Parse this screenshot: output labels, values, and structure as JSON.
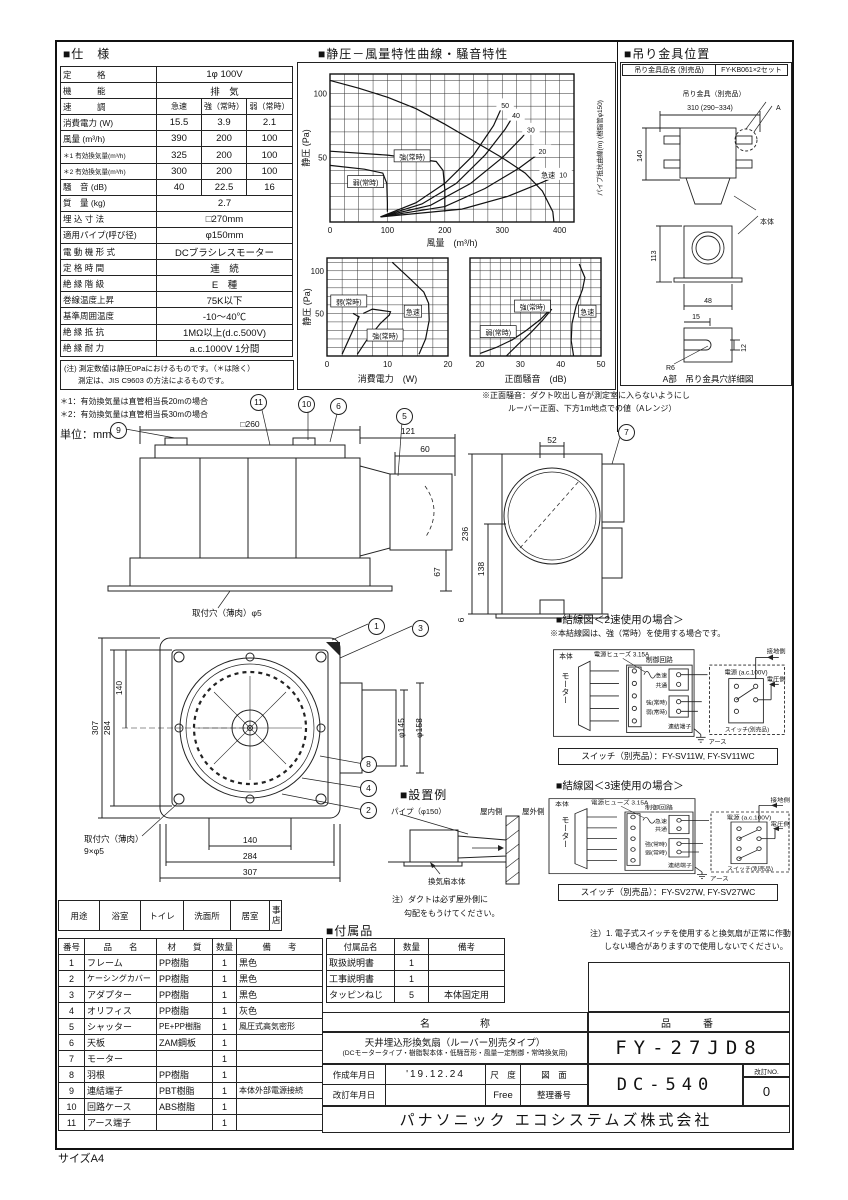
{
  "page": {
    "size_label": "サイズA4",
    "unit_label": "単位：mm"
  },
  "spec": {
    "title": "■仕　様",
    "rows": [
      {
        "label": "定　　　格",
        "value": "1φ 100V"
      },
      {
        "label": "機　　　能",
        "value": "排　気"
      },
      {
        "label": "速　　　調",
        "c1": "急速",
        "c2": "強（常時）",
        "c3": "弱（常時）"
      },
      {
        "label": "消費電力 (W)",
        "c1": "15.5",
        "c2": "3.9",
        "c3": "2.1"
      },
      {
        "label": "風量 (m³/h)",
        "c1": "390",
        "c2": "200",
        "c3": "100"
      },
      {
        "label": "＊1 有効換気量(m³/h)",
        "c1": "325",
        "c2": "200",
        "c3": "100"
      },
      {
        "label": "＊2 有効換気量(m³/h)",
        "c1": "300",
        "c2": "200",
        "c3": "100"
      },
      {
        "label": "騒　音 (dB)",
        "c1": "40",
        "c2": "22.5",
        "c3": "16"
      },
      {
        "label": "質　量 (kg)",
        "value": "2.7"
      },
      {
        "label": "埋 込 寸 法",
        "value": "□270mm"
      },
      {
        "label": "適用パイプ(呼び径)",
        "value": "φ150mm"
      },
      {
        "label": "電 動 機 形 式",
        "value": "DCブラシレスモーター"
      },
      {
        "label": "定 格 時 間",
        "value": "連　続"
      },
      {
        "label": "絶 縁 階 級",
        "value": "E　種"
      },
      {
        "label": "巻線温度上昇",
        "value": "75K以下"
      },
      {
        "label": "基準周囲温度",
        "value": "-10～40℃"
      },
      {
        "label": "絶 縁 抵 抗",
        "value": "1MΩ以上(d.c.500V)"
      },
      {
        "label": "絶 縁 耐 力",
        "value": "a.c.1000V 1分間"
      }
    ],
    "note1": "(注) 測定数値は静圧0Paにおけるものです。（＊は除く）",
    "note2": "測定は、JIS C9603 の方法によるものです。",
    "note3": "＊1：有効換気量は直管相当長20mの場合",
    "note4": "＊2：有効換気量は直管相当長30mの場合"
  },
  "charts": {
    "section_title": "■静圧－風量特性曲線・騒音特性",
    "note1": "※正面騒音：ダクト吹出し音が測定室に入らないようにし",
    "note2": "ルーバー正面、下方1m地点での値（Aレンジ）"
  },
  "chart_data": [
    {
      "id": "pq",
      "type": "line",
      "title": "静圧-風量特性曲線",
      "xlabel": "風量　(m³/h)",
      "ylabel": "静圧 (Pa)",
      "ylabel_right": "パイプ抵抗曲線(m) (樹脂管φ150)",
      "xlim": [
        0,
        425
      ],
      "ylim": [
        0,
        115
      ],
      "xgrid": 25,
      "ygrid": 10,
      "xticks": [
        0,
        100,
        200,
        300,
        400
      ],
      "yticks": [
        50,
        100
      ],
      "series": [
        {
          "name": "急速",
          "points": [
            [
              0,
              110
            ],
            [
              50,
              104
            ],
            [
              100,
              97
            ],
            [
              150,
              88
            ],
            [
              200,
              76
            ],
            [
              250,
              63
            ],
            [
              300,
              50
            ],
            [
              340,
              38
            ],
            [
              370,
              24
            ],
            [
              388,
              8
            ],
            [
              390,
              0
            ]
          ]
        },
        {
          "name": "強(常時)",
          "points": [
            [
              0,
              55
            ],
            [
              100,
              52
            ],
            [
              185,
              47
            ],
            [
              197,
              40
            ],
            [
              200,
              25
            ],
            [
              200,
              8
            ]
          ]
        },
        {
          "name": "弱(常時)",
          "points": [
            [
              0,
              44
            ],
            [
              60,
              41
            ],
            [
              92,
              38
            ],
            [
              99,
              30
            ],
            [
              100,
              15
            ],
            [
              100,
              8
            ]
          ]
        },
        {
          "name": "パイプ抵抗50m",
          "points": [
            [
              88,
              4
            ],
            [
              150,
              15
            ],
            [
              200,
              30
            ],
            [
              250,
              52
            ],
            [
              285,
              75
            ],
            [
              298,
              88
            ]
          ]
        },
        {
          "name": "パイプ抵抗40m",
          "points": [
            [
              88,
              4
            ],
            [
              160,
              14
            ],
            [
              220,
              30
            ],
            [
              270,
              52
            ],
            [
              305,
              72
            ],
            [
              316,
              80
            ]
          ]
        },
        {
          "name": "パイプ抵抗30m",
          "points": [
            [
              88,
              4
            ],
            [
              175,
              13
            ],
            [
              245,
              30
            ],
            [
              300,
              50
            ],
            [
              335,
              66
            ],
            [
              342,
              70
            ]
          ]
        },
        {
          "name": "パイプ抵抗20m",
          "points": [
            [
              88,
              4
            ],
            [
              200,
              12
            ],
            [
              270,
              26
            ],
            [
              330,
              42
            ],
            [
              360,
              52
            ]
          ]
        },
        {
          "name": "パイプ抵抗10m",
          "points": [
            [
              88,
              4
            ],
            [
              230,
              10
            ],
            [
              310,
              20
            ],
            [
              365,
              30
            ],
            [
              396,
              36
            ]
          ]
        }
      ],
      "labels": [
        {
          "text": "50",
          "x": 305,
          "y": 91
        },
        {
          "text": "40",
          "x": 324,
          "y": 83
        },
        {
          "text": "30",
          "x": 350,
          "y": 72
        },
        {
          "text": "20",
          "x": 370,
          "y": 55
        },
        {
          "text": "10",
          "x": 406,
          "y": 37
        },
        {
          "text": "急速",
          "x": 380,
          "y": 37
        },
        {
          "text": "強(常時)",
          "x": 143,
          "y": 51,
          "boxed": true
        },
        {
          "text": "弱(常時)",
          "x": 62,
          "y": 31,
          "boxed": true
        }
      ]
    },
    {
      "id": "power",
      "type": "line",
      "xlabel": "消費電力　(W)",
      "ylabel": "静圧 (Pa)",
      "xlim": [
        0,
        20
      ],
      "ylim": [
        0,
        115
      ],
      "xgrid": 2.5,
      "ygrid": 10,
      "xticks": [
        0,
        10,
        20
      ],
      "yticks": [
        50,
        100
      ],
      "series": [
        {
          "name": "弱(常時)",
          "points": [
            [
              2.5,
              2
            ],
            [
              3.5,
              18
            ],
            [
              4.8,
              38
            ],
            [
              5.3,
              46
            ],
            [
              4.3,
              50
            ]
          ]
        },
        {
          "name": "強(常時)",
          "points": [
            [
              5,
              2
            ],
            [
              6.5,
              18
            ],
            [
              8.8,
              38
            ],
            [
              10.3,
              48
            ],
            [
              10.5,
              52
            ],
            [
              7.5,
              55
            ],
            [
              6,
              50
            ]
          ]
        },
        {
          "name": "急速",
          "points": [
            [
              15.2,
              2
            ],
            [
              16.3,
              20
            ],
            [
              16.9,
              42
            ],
            [
              16.8,
              62
            ],
            [
              16,
              75
            ],
            [
              13.5,
              92
            ],
            [
              10.8,
              110
            ]
          ]
        }
      ],
      "labels": [
        {
          "text": "弱(常時)",
          "x": 3.6,
          "y": 64,
          "boxed": true
        },
        {
          "text": "強(常時)",
          "x": 9.6,
          "y": 24,
          "boxed": true
        },
        {
          "text": "急速",
          "x": 14.2,
          "y": 52,
          "boxed": true
        }
      ]
    },
    {
      "id": "noise",
      "type": "line",
      "xlabel": "正面騒音　(dB)",
      "xlim": [
        17.5,
        50
      ],
      "ylim": [
        0,
        115
      ],
      "xgrid": 2.5,
      "ygrid": 10,
      "xticks": [
        20,
        30,
        40,
        50
      ],
      "yticks": [],
      "series": [
        {
          "name": "弱(常時)",
          "points": [
            [
              20,
              3
            ],
            [
              24,
              10
            ],
            [
              28,
              19
            ],
            [
              31.5,
              30
            ],
            [
              35,
              43
            ],
            [
              37.5,
              55
            ]
          ]
        },
        {
          "name": "強(常時)",
          "points": [
            [
              26.5,
              0
            ],
            [
              29.5,
              14
            ],
            [
              32.5,
              27
            ],
            [
              35.5,
              42
            ],
            [
              37.8,
              55
            ]
          ]
        },
        {
          "name": "急速",
          "points": [
            [
              43.2,
              0
            ],
            [
              42.6,
              18
            ],
            [
              42.8,
              38
            ],
            [
              43.8,
              58
            ],
            [
              45.4,
              78
            ],
            [
              46,
              92
            ],
            [
              44.6,
              108
            ]
          ]
        }
      ],
      "labels": [
        {
          "text": "弱(常時)",
          "x": 24.5,
          "y": 28,
          "boxed": true
        },
        {
          "text": "強(常時)",
          "x": 33,
          "y": 58,
          "boxed": true
        },
        {
          "text": "急速",
          "x": 46.6,
          "y": 52,
          "boxed": true
        }
      ]
    }
  ],
  "bracket": {
    "title": "■吊り金具位置",
    "part_label": "吊り金具品名 (別売品)",
    "part_value": "FY-KB061×2セット",
    "hanger_label": "吊り金具（別売品）",
    "dim140": "140",
    "dim310": "310 (290~334)",
    "mark_a": "A",
    "body_label": "本体",
    "dim113": "113",
    "dim48": "48",
    "dim15": "15",
    "dim12": "12",
    "dimr6": "R6",
    "caption": "A部　吊り金具穴詳細図"
  },
  "drawings": {
    "dim260": "□260",
    "dim121": "121",
    "dim60": "60",
    "dim236": "236",
    "dim67": "67",
    "dim6": "6",
    "hole5": "取付穴（薄肉）φ5",
    "dim52": "52",
    "dim138": "138",
    "dim307a": "307",
    "dim284a": "284",
    "dim140a": "140",
    "dim140b": "140",
    "dim284b": "284",
    "dim307b": "307",
    "d145": "φ145",
    "d158": "φ158",
    "hole9a": "取付穴（薄肉）",
    "hole9b": "9×φ5"
  },
  "install": {
    "title": "■設置例",
    "pipe": "パイプ（φ150）",
    "indoor": "屋内側",
    "outdoor": "屋外側",
    "body": "換気扇本体",
    "note1": "注）ダクトは必ず屋外側に",
    "note2": "勾配をもうけてください。"
  },
  "wiring2": {
    "title": "■結線図＜2速使用の場合＞",
    "note": "※本結線図は、強（常時）を使用する場合です。",
    "body": "本体",
    "motor": "モーター",
    "fuse": "電源ヒューズ 3.15A",
    "control": "制御回路",
    "t1": "急速",
    "t2": "共通",
    "t3": "強(常時)",
    "t4": "弱(常時)",
    "terminal": "連結端子",
    "power": "電源 (a.c.100V)",
    "ground": "接地側",
    "volt": "電圧側",
    "switch": "スイッチ(別売品)",
    "earth": "アース",
    "models": "スイッチ（別売品）：FY-SV11W, FY-SV11WC"
  },
  "wiring3": {
    "title": "■結線図＜3速使用の場合＞",
    "body": "本体",
    "motor": "モーター",
    "fuse": "電源ヒューズ 3.15A",
    "control": "制御回路",
    "t1": "急速",
    "t2": "共通",
    "t3": "強(常時)",
    "t4": "弱(常時)",
    "terminal": "連結端子",
    "power": "電源 (a.c.100V)",
    "ground": "接地側",
    "volt": "電圧側",
    "switch": "スイッチ(別売品)",
    "earth": "アース",
    "models": "スイッチ（別売品）：FY-SV27W, FY-SV27WC",
    "note1": "注）1. 電子式スイッチを使用すると換気扇が正常に作動",
    "note2": "しない場合がありますので使用しないでください。"
  },
  "usage": {
    "h": "用途",
    "c1": "浴室",
    "c2": "トイレ",
    "c3": "洗面所",
    "c4": "居室",
    "c5a": "事務所",
    "c5b": "店舗"
  },
  "parts": {
    "h_no": "番号",
    "h_name": "品　　名",
    "h_mat": "材　　質",
    "h_qty": "数量",
    "h_rem": "備　　考",
    "rows": [
      {
        "no": "1",
        "name": "フレーム",
        "mat": "PP樹脂",
        "qty": "1",
        "rem": "黒色"
      },
      {
        "no": "2",
        "name": "ケーシングカバー",
        "mat": "PP樹脂",
        "qty": "1",
        "rem": "黒色"
      },
      {
        "no": "3",
        "name": "アダプター",
        "mat": "PP樹脂",
        "qty": "1",
        "rem": "黒色"
      },
      {
        "no": "4",
        "name": "オリフィス",
        "mat": "PP樹脂",
        "qty": "1",
        "rem": "灰色"
      },
      {
        "no": "5",
        "name": "シャッター",
        "mat": "PE+PP樹脂",
        "qty": "1",
        "rem": "風圧式高気密形"
      },
      {
        "no": "6",
        "name": "天板",
        "mat": "ZAM鋼板",
        "qty": "1",
        "rem": ""
      },
      {
        "no": "7",
        "name": "モーター",
        "mat": "",
        "qty": "1",
        "rem": ""
      },
      {
        "no": "8",
        "name": "羽根",
        "mat": "PP樹脂",
        "qty": "1",
        "rem": ""
      },
      {
        "no": "9",
        "name": "連結端子",
        "mat": "PBT樹脂",
        "qty": "1",
        "rem": "本体外部電源接続"
      },
      {
        "no": "10",
        "name": "回路ケース",
        "mat": "ABS樹脂",
        "qty": "1",
        "rem": ""
      },
      {
        "no": "11",
        "name": "アース端子",
        "mat": "",
        "qty": "1",
        "rem": ""
      }
    ]
  },
  "accessories": {
    "title": "■付属品",
    "h_name": "付属品名",
    "h_qty": "数量",
    "h_rem": "備考",
    "rows": [
      {
        "name": "取扱説明書",
        "qty": "1",
        "rem": ""
      },
      {
        "name": "工事説明書",
        "qty": "1",
        "rem": ""
      },
      {
        "name": "タッピンねじ",
        "qty": "5",
        "rem": "本体固定用"
      }
    ]
  },
  "titleblock": {
    "name_header": "名　　　　　称",
    "name1": "天井埋込形換気扇（ルーバー別売タイプ）",
    "name2": "(DCモータータイプ・樹脂製本体・低騒音形・風量一定制御・常時換気用)",
    "hinban_header": "品　　番",
    "model": "FY-27JD8",
    "created_label": "作成年月日",
    "created": "'19.12.24",
    "scale_label": "尺　度",
    "zumen_label": "図　面",
    "revised_label": "改訂年月日",
    "scale": "Free",
    "seiri_label": "整理番号",
    "drawing_no": "DC-540",
    "rev_label": "改訂NO.",
    "rev": "0",
    "company": "パナソニック エコシステムズ株式会社"
  }
}
